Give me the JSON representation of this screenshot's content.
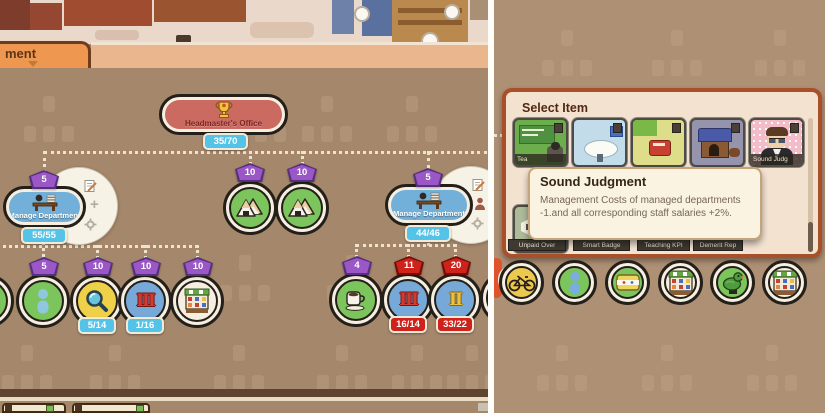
{
  "window": {
    "tab_label": "ment"
  },
  "colors": {
    "background_left": "#a5876b",
    "background_right": "#ae9075",
    "divider": "#ffffff",
    "panel_border": "#a8502a",
    "pill_blue": "#72b0d9",
    "headmaster_red": "#ca6a61",
    "badge_purple": "#9a57c5",
    "badge_red": "#cf221a",
    "count_blue": "#54c3e8",
    "alert_glow": "#e83e19",
    "node_green": "#7cc45c",
    "node_yellow": "#efd049",
    "node_blue": "#76a9d8"
  },
  "tree": {
    "headmaster": {
      "label": "Headmaster's Office",
      "count": "35/70"
    },
    "dept_left": {
      "badge": "5",
      "label": "Manage Department",
      "count": "55/55"
    },
    "dept_right": {
      "badge": "5",
      "label": "Manage Department",
      "count": "44/46"
    },
    "mid_nodes": [
      {
        "badge": "10"
      },
      {
        "badge": "10"
      }
    ],
    "left_children": [
      {
        "badge": "5"
      },
      {
        "badge": "10",
        "count": "5/14"
      },
      {
        "badge": "10",
        "count": "1/16",
        "numeral": "III"
      },
      {
        "badge": "10"
      }
    ],
    "right_children": [
      {
        "badge": "4"
      },
      {
        "badge": "11",
        "count": "16/14",
        "numeral": "III"
      },
      {
        "badge": "20",
        "count": "33/22",
        "numeral": "II"
      }
    ],
    "fan_plus_label": "+"
  },
  "select_panel": {
    "title": "Select Item",
    "row1": [
      {
        "label": "Tea"
      },
      {
        "label": ""
      },
      {
        "label": ""
      },
      {
        "label": ""
      },
      {
        "label": "Sound Judg"
      }
    ],
    "row2_labels": [
      "Unpaid Over",
      "Smart Badge",
      "Teaching KPI",
      "Demerit Rep"
    ],
    "tooltip": {
      "title": "Sound Judgment",
      "body": "Management Costs of managed departments -1.and all corresponding staff salaries +2%."
    }
  }
}
